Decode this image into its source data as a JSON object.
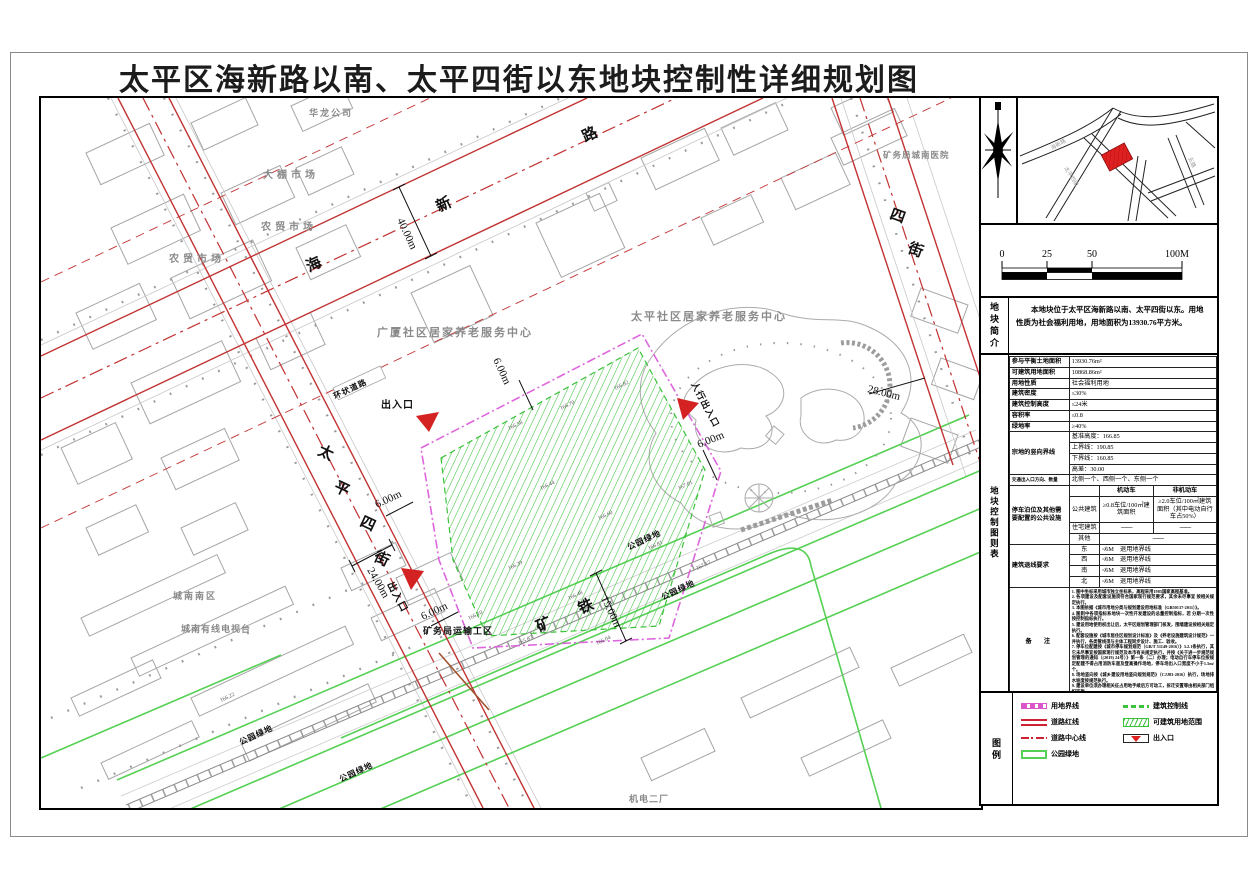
{
  "title": "太平区海新路以南、太平四街以东地块控制性详细规划图",
  "map": {
    "road_haixin": [
      "海",
      "新",
      "路"
    ],
    "road_taiping4": [
      "太",
      "平",
      "四",
      "街"
    ],
    "road_4": [
      "四",
      "街"
    ],
    "railway": [
      "矿",
      "铁"
    ],
    "facilities": {
      "hualong": "华龙公司",
      "dapeng": "大棚市场",
      "nongmao1": "农贸市场",
      "nongmao2": "农贸市场",
      "hospital": "矿务局城南医院",
      "guangsha": "广厦社区居家养老服务中心",
      "taiping_center": "太平社区居家养老服务中心",
      "chengnan_nanqu": "城南南区",
      "tv": "城南有线电视台",
      "transport": "矿务局运输工区",
      "jidian": "机电二厂",
      "ring_road": "环状道路"
    },
    "green_label": "公园绿地",
    "entrance": "出入口",
    "ped_entrance": "人行出入口",
    "dims": {
      "d40": "40.00m",
      "d28": "28.00m",
      "d24": "24.00m",
      "d6": "6.00m",
      "d15": "15.00m"
    },
    "elevations": [
      "166.58",
      "166.70",
      "166.82",
      "166.44",
      "166.60",
      "166.81",
      "167.01",
      "167.17",
      "166.39",
      "166.48",
      "166.10",
      "165.87",
      "166.04",
      "166.22"
    ]
  },
  "sidebar": {
    "scale_ticks": [
      "0",
      "25",
      "50",
      "100M"
    ],
    "intro": {
      "side_label": "地块简介",
      "text": "本地块位于太平区海新路以南、太平四街以东。用地性质为社会福利用地，用地面积为13930.76平方米。"
    },
    "table": {
      "side_label": "地块控制图则表",
      "rows": [
        {
          "k": "参与平衡土地面积",
          "v": "13930.76m²"
        },
        {
          "k": "可建筑用地面积",
          "v": "10868.86m²"
        },
        {
          "k": "用地性质",
          "v": "社会福利用地"
        },
        {
          "k": "建筑密度",
          "v": "≤30%"
        },
        {
          "k": "建筑控制高度",
          "v": "≤24米"
        },
        {
          "k": "容积率",
          "v": "≤0.8"
        },
        {
          "k": "绿地率",
          "v": "≥40%"
        }
      ],
      "vertical": {
        "k": "宗地的竖向界线",
        "v": [
          "基准高度：166.85",
          "上界线：190.85",
          "下界线：160.85",
          "高差：30.00"
        ]
      },
      "traffic": {
        "k": "交通出入口方向、数量",
        "v": "北侧一个、西侧一个、东侧一个"
      },
      "parking": {
        "k": "停车泊位及其他需要配置的公共设施",
        "col1": "机动车",
        "col2": "非机动车",
        "r1": {
          "k": "公共建筑",
          "v1": "≥0.8车位/100㎡建筑面积",
          "v2": "≥2.0车位/100㎡建筑面积（其中电动自行车占50%）"
        },
        "r2": {
          "k": "住宅建筑",
          "v1": "——",
          "v2": "——"
        },
        "r3": {
          "k": "其他",
          "v": "——"
        }
      },
      "setback": {
        "k": "建筑退线要求",
        "rows": [
          {
            "d": "东",
            "v": "≮6M　退用地界线"
          },
          {
            "d": "西",
            "v": "≮6M　退用地界线"
          },
          {
            "d": "南",
            "v": "≮6M　退用地界线"
          },
          {
            "d": "北",
            "v": "≮6M　退用地界线"
          }
        ]
      },
      "notes_label": "备　注",
      "notes": [
        "1. 图中坐标采用城市独立坐标系，高程采用1985国家高程基准。",
        "2. 各项建设及配套设施须符合国家现行规范要求，其余未尽事宜 按相关规定执行。",
        "3. 本图依据《城市用地分类与规划建设用地标准（GB50137-2011）》。",
        "4. 图则中各项指标系地块一次性开发建设的总量控制指标，若 分期一次性按控制指标执行。",
        "5. 建设用地使用权出让后，太平区规划管理部门核发，围墙建设按相关规定执行。",
        "6. 配套设施按《城市居住区规划设计标准》及《养老设施建筑设计规范》一并执行，各类管线须与主体工程同步设计、施工、验收。",
        "7. 停车位配建按《城市停车规划规范（GB/T 51149-2016）》3.2.1条执行，其它未尽事宜按国家现行规范及本市有关规定执行，并按《关于进一步规范规划管理的通知（(2019) 24号）》第一条（二）办理；电动自行车停车位按规定配建不得占用消防车道及登高操作场地，停车场出入口宽度不小于1.5m/个。",
        "8. 场地竖向按《城乡建设用地竖向规划规范》（CJJ83-2016）执行，场地排水坡度按规范执行。",
        "9. 建设单位须办理相关征占用地手续后方可动工，拆迁安置等由相关部门组织实施。"
      ]
    },
    "legend": {
      "side_label": "图例",
      "items_left": [
        {
          "t": "用地界线"
        },
        {
          "t": "道路红线"
        },
        {
          "t": "道路中心线"
        },
        {
          "t": "公园绿地"
        }
      ],
      "items_right": [
        {
          "t": "建筑控制线"
        },
        {
          "t": "可建筑用地范围"
        },
        {
          "t": "出入口"
        }
      ]
    }
  }
}
